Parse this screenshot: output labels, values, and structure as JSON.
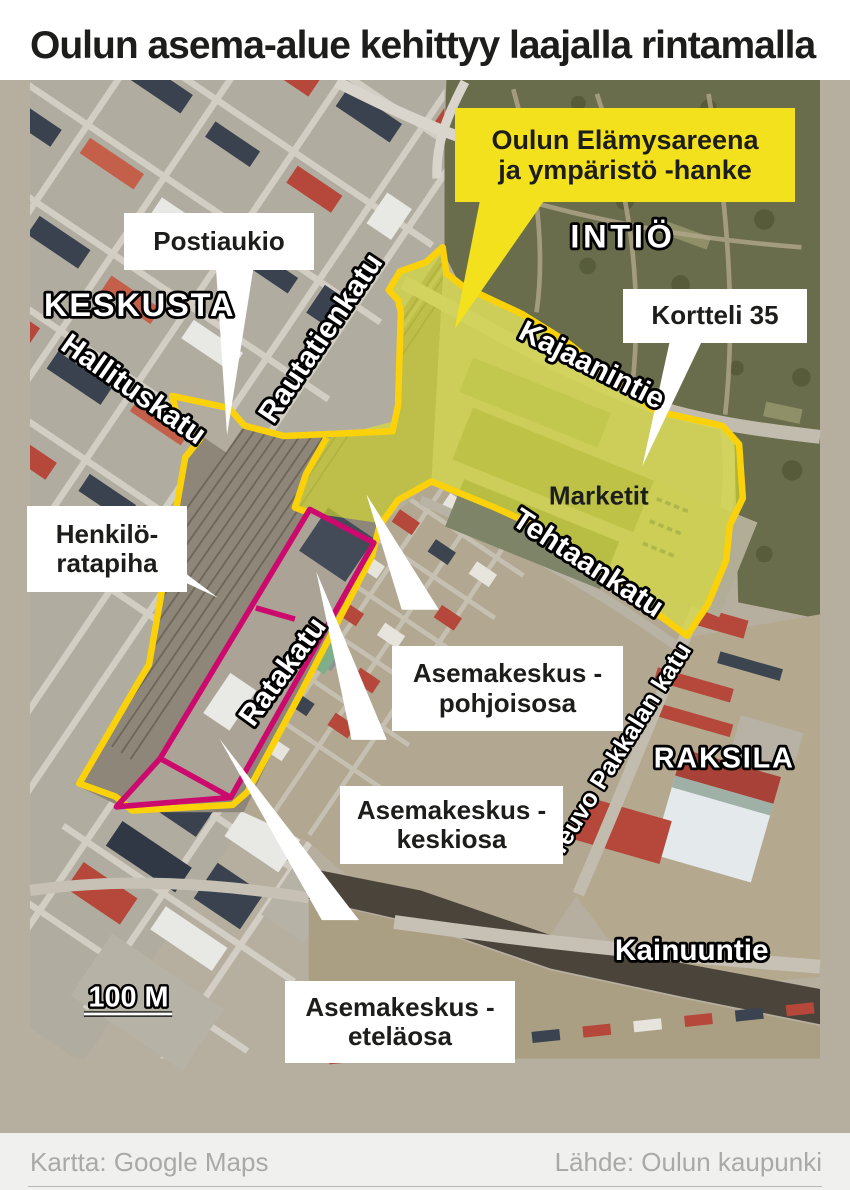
{
  "title": "Oulun asema-alue kehittyy laajalla rintamalla",
  "map": {
    "project_callout": {
      "line1": "Oulun Elämysareena",
      "line2": "ja ympäristö -hanke"
    },
    "callouts": {
      "postiaukio": {
        "label": "Postiaukio"
      },
      "kortteli_35": {
        "label": "Kortteli 35"
      },
      "henkilo_ratapiha": {
        "line1": "Henkilö-",
        "line2": "ratapiha"
      },
      "asemakeskus_pohjoisosa": {
        "line1": "Asemakeskus -",
        "line2": "pohjoisosa"
      },
      "asemakeskus_keskiosa": {
        "line1": "Asemakeskus -",
        "line2": "keskiosa"
      },
      "asemakeskus_etelaosa": {
        "line1": "Asemakeskus -",
        "line2": "eteläosa"
      }
    },
    "area_labels": {
      "keskusta": "KESKUSTA",
      "intio": "INTIÖ",
      "raksila": "RAKSILA"
    },
    "street_labels": {
      "hallituskatu": "Hallituskatu",
      "rautatienkatu": "Rautatienkatu",
      "kajaanintie": "Kajaanintie",
      "tehtaankatu": "Tehtaankatu",
      "ratakatu": "Ratakatu",
      "teuvo_pakkalan_katu": "Teuvo Pakkalan katu",
      "kainuuntie": "Kainuuntie"
    },
    "place_labels": {
      "marketit": "Marketit"
    },
    "scale_label": "100 M",
    "colors": {
      "project_area_border": "#FBD20A",
      "project_area_fill": "#DCE22E",
      "asemakeskus_outline": "#CC0A6E",
      "project_callout_bg": "#F3E11D"
    }
  },
  "footer": {
    "map_credit": "Kartta: Google Maps",
    "source_credit": "Lähde: Oulun kaupunki"
  }
}
